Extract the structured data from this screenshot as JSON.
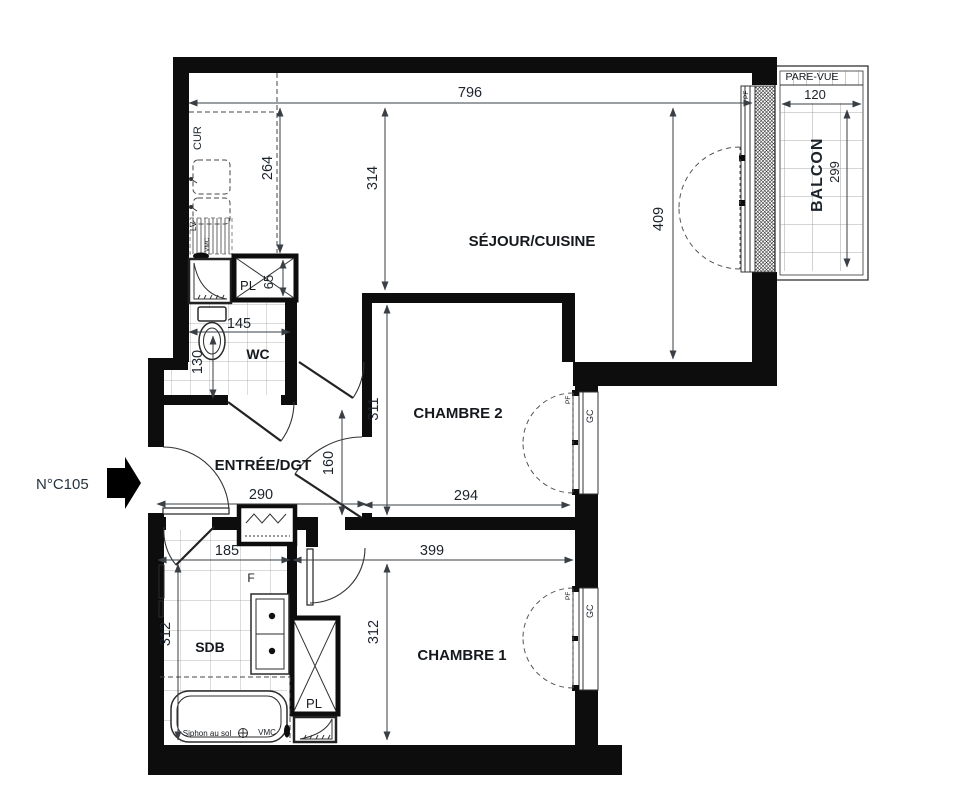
{
  "meta": {
    "unit_label": "N°C105"
  },
  "rooms": {
    "sejour": "SÉJOUR/CUISINE",
    "chambre1": "CHAMBRE 1",
    "chambre2": "CHAMBRE 2",
    "entree": "ENTRÉE/DGT",
    "wc": "WC",
    "sdb": "SDB",
    "balcon": "BALCON",
    "pare_vue": "PARE-VUE",
    "pl_top": "PL",
    "pl_bottom": "PL",
    "kitchen_counter": "CUR",
    "f_label": "F"
  },
  "annotations": {
    "siphon": "Siphon au sol",
    "vmc": "VMC",
    "lv": "LV",
    "gc": "GC",
    "pf": "PF"
  },
  "dimensions_cm": {
    "sejour_width": "796",
    "kitchen_depth": "264",
    "sejour_depth": "314",
    "sejour_right_depth": "409",
    "balcon_width": "120",
    "balcon_depth": "299",
    "pl_top_depth": "65",
    "wc_width": "145",
    "wc_depth": "130",
    "entree_width": "290",
    "entree_passage": "160",
    "chambre2_depth": "311",
    "chambre2_width": "294",
    "sdb_width": "185",
    "sdb_depth": "312",
    "chambre1_width": "399",
    "chambre1_depth": "312"
  }
}
